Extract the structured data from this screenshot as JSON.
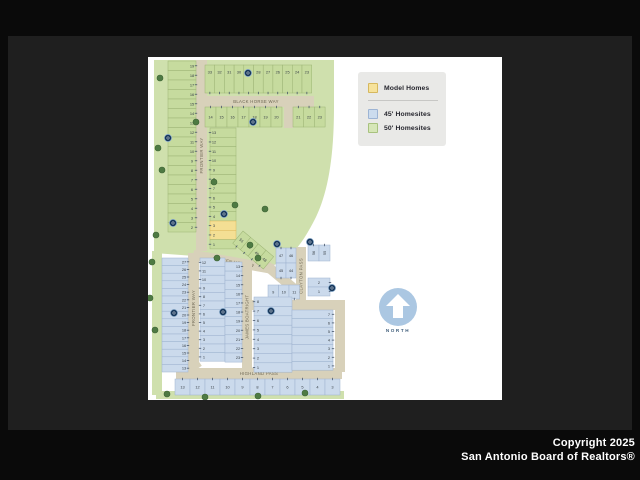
{
  "window": {
    "copyright_line1": "Copyright 2025",
    "copyright_line2": "San Antonio Board of Realtors®"
  },
  "legend": {
    "items": [
      {
        "id": "model-homes",
        "label": "Model Homes",
        "swatch": "#f6e29b",
        "swatch_border": "#d6b85e"
      },
      {
        "id": "45-homesites",
        "label": "45' Homesites",
        "swatch": "#ccdcee",
        "swatch_border": "#9db4d4"
      },
      {
        "id": "50-homesites",
        "label": "50' Homesites",
        "swatch": "#d6e6b7",
        "swatch_border": "#a8c27e"
      }
    ]
  },
  "north_arrow": {
    "label": "NORTH"
  },
  "map": {
    "palette": {
      "field": "#cfe0ad",
      "street": "#d8d1ba",
      "street_text": "#6e6753",
      "green_fill": "#c6db9e",
      "green_stroke": "#9cb474",
      "blue_fill": "#cbdaec",
      "blue_stroke": "#9db2cf",
      "model_fill": "#f4df94",
      "model_stroke": "#ddb95a",
      "number": "#3a4147",
      "tick": "#49576b",
      "marker_fill": "#16365a",
      "marker_ring": "#8fb0cf",
      "tree": "#4e7a43",
      "tree_stroke": "#3c6333"
    },
    "fields": [
      "M6,3 L186,3 L186,50 C186,100 180,135 168,160 C158,180 148,196 132,206 L110,213 L92,210 L60,200 L6,196 Z",
      "M4,194 L14,194 L14,338 L4,338 Z",
      "M8,334 L196,334 L196,342 L8,342 Z"
    ],
    "streets": [
      {
        "id": "black-horse-way",
        "name": "BLACK HORSE WAY",
        "x": 50,
        "y": 39,
        "w": 116,
        "h": 11
      },
      {
        "id": "frontier-way-upper",
        "name": "FRONTIER WAY",
        "x": 48,
        "y": 3,
        "w": 11,
        "h": 191
      },
      {
        "id": "cross-street",
        "name": "",
        "x": 136,
        "y": 49,
        "w": 9,
        "h": 22
      },
      {
        "id": "broken-hollow",
        "name": "BROKEN HOLLOW",
        "x": 46,
        "y": 193,
        "w": 82,
        "h": 10,
        "angle": 10
      },
      {
        "id": "broken-hollow-bend",
        "name": "",
        "x": 122,
        "y": 205,
        "w": 44,
        "h": 10,
        "angle": 40
      },
      {
        "id": "clayton-pass",
        "name": "CLAYTON PASS",
        "x": 148,
        "y": 190,
        "w": 10,
        "h": 58
      },
      {
        "id": "connector-street",
        "name": "",
        "x": 100,
        "y": 243,
        "w": 97,
        "h": 10
      },
      {
        "id": "james-boatright",
        "name": "JAMES BOATRIGHT",
        "x": 94,
        "y": 203,
        "w": 10,
        "h": 114
      },
      {
        "id": "highland-pass",
        "name": "HIGHLAND PASS",
        "x": 28,
        "y": 311,
        "w": 166,
        "h": 11
      },
      {
        "id": "east-street",
        "name": "",
        "x": 187,
        "y": 251,
        "w": 10,
        "h": 64
      },
      {
        "id": "frontier-way-lower",
        "name": "FRONTIER WAY",
        "x": 40,
        "y": 196,
        "w": 11,
        "h": 110
      },
      {
        "id": "frontier-curve",
        "name": "",
        "x": 32,
        "y": 302,
        "w": 14,
        "h": 18,
        "angle": -35
      }
    ],
    "sections": [
      {
        "id": "top-row",
        "type": "row",
        "x": 57,
        "y": 8,
        "lot_w": 9.7,
        "lot_h": 28,
        "color": "green",
        "tick": "bottom",
        "num_pos": "top",
        "numbers": [
          33,
          32,
          31,
          30,
          29,
          28,
          27,
          26,
          25,
          24,
          23
        ]
      },
      {
        "id": "row2-left",
        "type": "row",
        "x": 57,
        "y": 50,
        "lot_w": 11,
        "lot_h": 20,
        "color": "green",
        "tick": "top",
        "numbers": [
          14,
          15,
          16,
          17,
          18,
          19,
          20
        ]
      },
      {
        "id": "row2-right",
        "type": "row",
        "x": 145,
        "y": 50,
        "lot_w": 10.7,
        "lot_h": 20,
        "color": "green",
        "tick": "top",
        "numbers": [
          21,
          22,
          23
        ]
      },
      {
        "id": "left-col-upper",
        "type": "col",
        "x": 20,
        "y": 4,
        "lot_w": 28,
        "lot_h": 9.5,
        "color": "green",
        "tick": "right",
        "num_pos": "right",
        "numbers": [
          19,
          18,
          17,
          16,
          15,
          14,
          13,
          12,
          11,
          10,
          9,
          8,
          7,
          6,
          5,
          4,
          3,
          2
        ]
      },
      {
        "id": "inner-col",
        "type": "col",
        "x": 62,
        "y": 71,
        "lot_w": 26,
        "lot_h": 9.3,
        "color": "green",
        "tick": "left",
        "num_pos": "left",
        "numbers": [
          13,
          12,
          11,
          10,
          9,
          8,
          7,
          6,
          5,
          4,
          3,
          2,
          1
        ],
        "model": [
          3,
          2
        ]
      },
      {
        "id": "diag-lots",
        "type": "row",
        "x": 95,
        "y": 174,
        "lot_w": 10,
        "lot_h": 16,
        "color": "green",
        "tick": "bottom",
        "angle": 40,
        "numbers": [
          51,
          50,
          49,
          48
        ]
      },
      {
        "id": "clayton-west-1",
        "type": "row",
        "x": 128,
        "y": 191,
        "lot_w": 10,
        "lot_h": 15,
        "color": "blue",
        "tick": "top",
        "numbers": [
          47,
          46
        ]
      },
      {
        "id": "clayton-west-2",
        "type": "row",
        "x": 128,
        "y": 206,
        "lot_w": 10,
        "lot_h": 15,
        "color": "blue",
        "tick": "bottom",
        "numbers": [
          45,
          44
        ]
      },
      {
        "id": "clayton-east",
        "type": "row",
        "x": 160,
        "y": 188,
        "lot_w": 11,
        "lot_h": 16,
        "color": "blue",
        "tick": "top",
        "rot_text": true,
        "numbers": [
          56,
          55
        ]
      },
      {
        "id": "east-pair",
        "type": "col",
        "x": 160,
        "y": 221,
        "lot_w": 22,
        "lot_h": 9,
        "color": "blue",
        "tick": "right",
        "numbers": [
          2,
          1
        ]
      },
      {
        "id": "mid-row",
        "type": "row",
        "x": 120,
        "y": 228,
        "lot_w": 10.5,
        "lot_h": 14,
        "color": "blue",
        "tick": "bottom",
        "numbers": [
          9,
          10,
          11
        ]
      },
      {
        "id": "central-left",
        "type": "col",
        "x": 52,
        "y": 201,
        "lot_w": 25,
        "lot_h": 8.6,
        "color": "blue",
        "tick": "left",
        "num_pos": "left",
        "numbers": [
          12,
          11,
          10,
          9,
          8,
          7,
          6,
          5,
          4,
          3,
          2,
          1
        ]
      },
      {
        "id": "central-right",
        "type": "col",
        "x": 77,
        "y": 205,
        "lot_w": 17,
        "lot_h": 9.1,
        "color": "blue",
        "tick": "right",
        "num_pos": "right",
        "numbers": [
          13,
          14,
          15,
          16,
          17,
          18,
          19,
          20,
          21,
          22,
          23
        ]
      },
      {
        "id": "jb-east-col",
        "type": "col",
        "x": 106,
        "y": 240,
        "lot_w": 38,
        "lot_h": 9.4,
        "color": "blue",
        "tick": "left",
        "num_pos": "left",
        "numbers": [
          8,
          7,
          6,
          5,
          4,
          3,
          2,
          1
        ]
      },
      {
        "id": "far-right-col",
        "type": "col",
        "x": 144,
        "y": 253,
        "lot_w": 41,
        "lot_h": 8.6,
        "color": "blue",
        "tick": "right",
        "num_pos": "right",
        "numbers": [
          7,
          6,
          5,
          4,
          3,
          2,
          1
        ]
      },
      {
        "id": "left-col-lower",
        "type": "col",
        "x": 14,
        "y": 201,
        "lot_w": 26,
        "lot_h": 7.6,
        "color": "blue",
        "tick": "right",
        "num_pos": "right",
        "numbers": [
          27,
          26,
          25,
          24,
          23,
          22,
          21,
          20,
          19,
          18,
          17,
          16,
          15,
          14,
          13
        ]
      },
      {
        "id": "bottom-row",
        "type": "row",
        "x": 27,
        "y": 322,
        "lot_w": 15,
        "lot_h": 16,
        "color": "blue",
        "tick": "top",
        "numbers": [
          13,
          12,
          11,
          10,
          9,
          8,
          7,
          6,
          5,
          4,
          3
        ]
      }
    ],
    "markers": [
      [
        100,
        16
      ],
      [
        105,
        65
      ],
      [
        20,
        81
      ],
      [
        25,
        166
      ],
      [
        76,
        157
      ],
      [
        129,
        187
      ],
      [
        162,
        185
      ],
      [
        184,
        231
      ],
      [
        26,
        256
      ],
      [
        75,
        255
      ],
      [
        123,
        254
      ]
    ],
    "trees": [
      [
        12,
        21
      ],
      [
        10,
        91
      ],
      [
        14,
        113
      ],
      [
        8,
        178
      ],
      [
        4,
        205
      ],
      [
        2,
        241
      ],
      [
        7,
        273
      ],
      [
        48,
        65
      ],
      [
        66,
        125
      ],
      [
        87,
        148
      ],
      [
        117,
        152
      ],
      [
        102,
        188
      ],
      [
        69,
        201
      ],
      [
        110,
        201
      ],
      [
        19,
        337
      ],
      [
        57,
        340
      ],
      [
        110,
        339
      ],
      [
        157,
        336
      ]
    ]
  }
}
